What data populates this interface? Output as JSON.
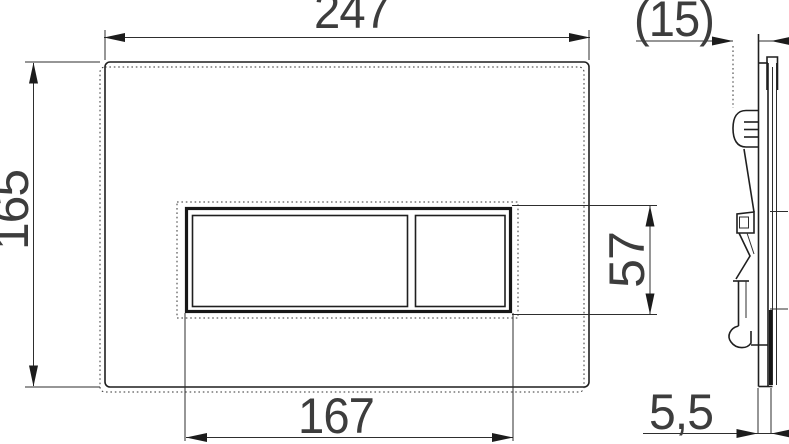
{
  "page": {
    "background_color": "#ffffff",
    "line_color": "#1f1f1f",
    "text_color": "#3d3d3d"
  },
  "drawing": {
    "kind": "technical dimension drawing: flush plate, front view and side profile",
    "front_view": {
      "plate_width_label": "247",
      "plate_height_label": "165",
      "button_opening_width_label": "167",
      "button_opening_height_label": "57"
    },
    "side_view": {
      "overall_depth_label": "(15)",
      "plate_thickness_label": "5,5"
    }
  }
}
